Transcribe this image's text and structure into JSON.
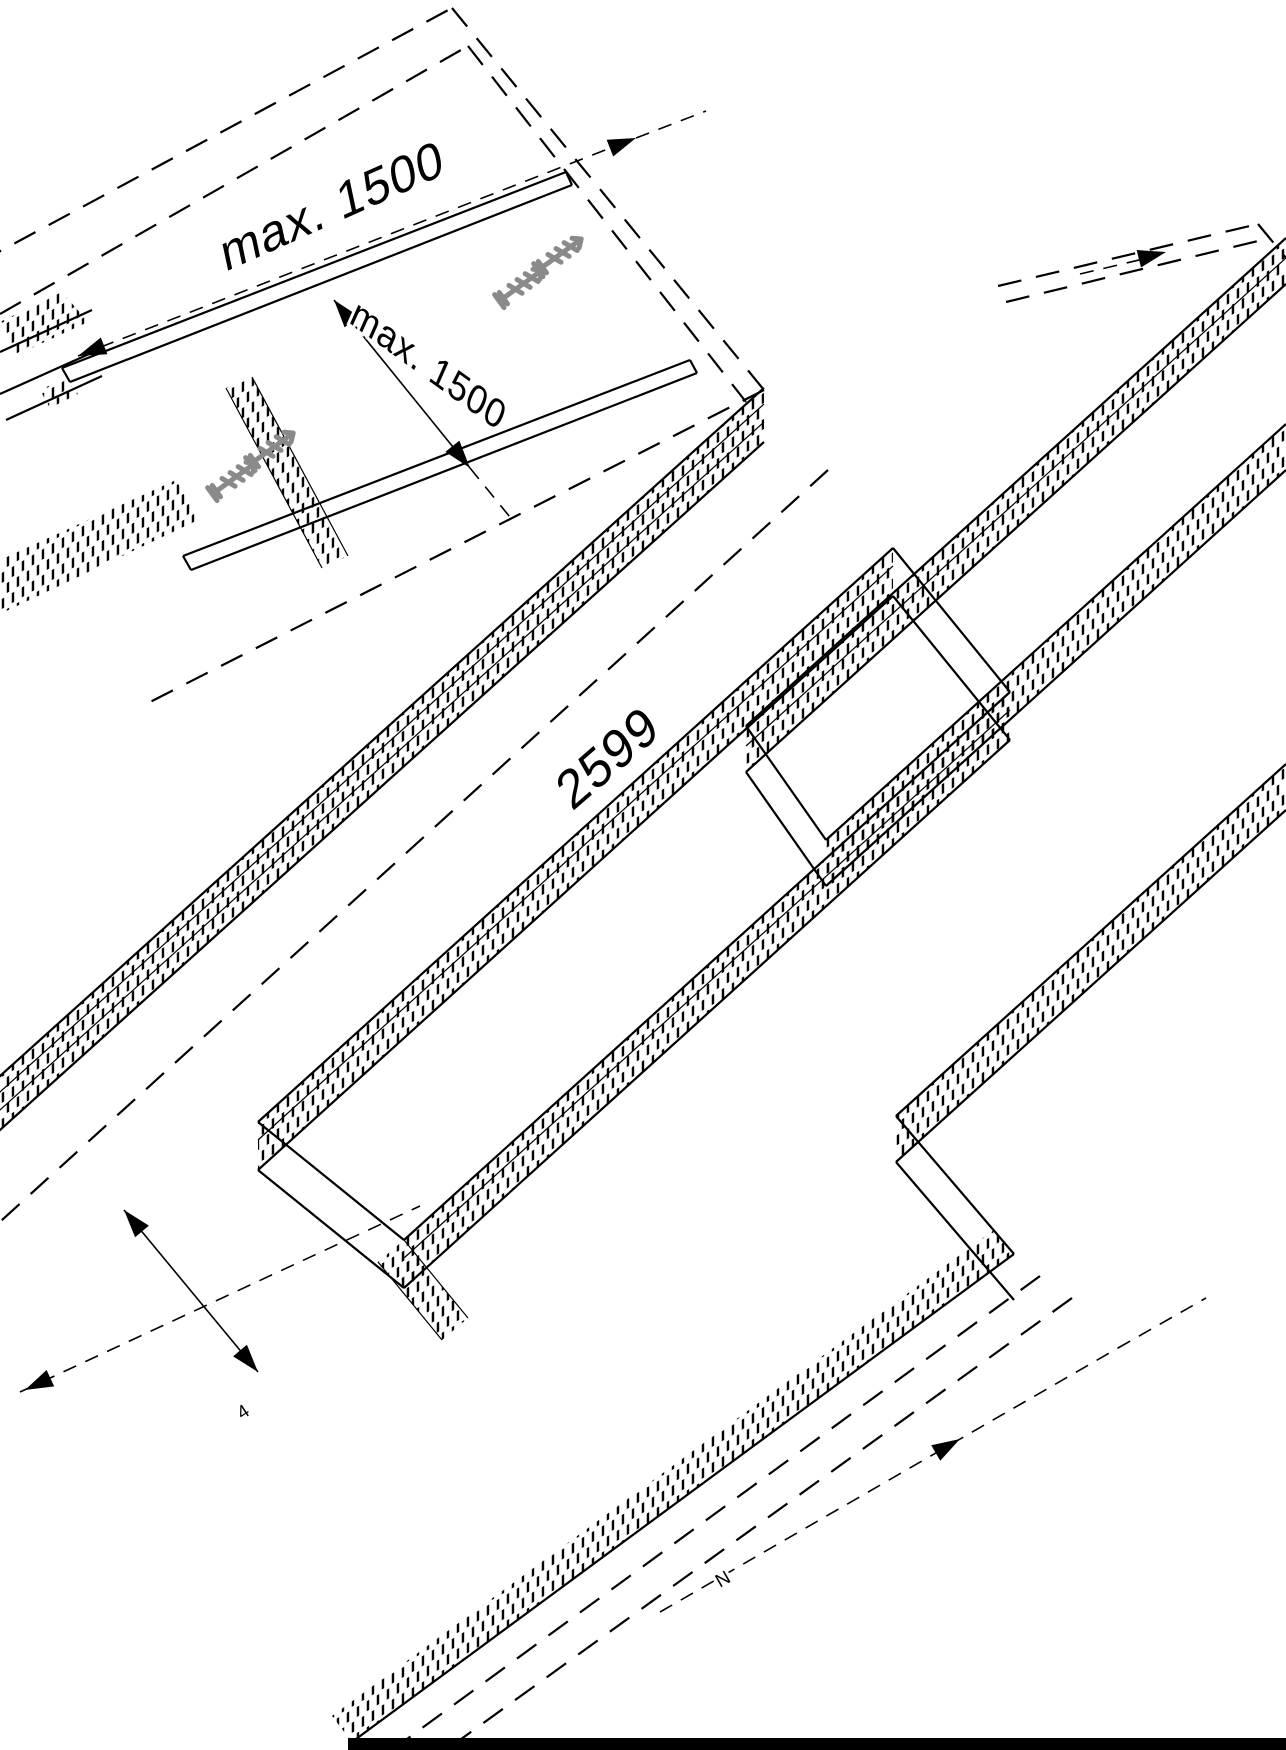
{
  "figure": {
    "type": "isometric-assembly-drawing",
    "description": "Mounting of sandwich panels onto battens fixed on a roof deck",
    "labels": {
      "dim_batten_spacing_top": "max. 1500",
      "dim_batten_spacing_mid": "max. 1500",
      "dim_panel_length": "2599",
      "dim_edge_small": "4",
      "dim_bottom_small": "N"
    },
    "colors": {
      "ink": "#000000",
      "screw": "#8a8a8a",
      "background": "#ffffff"
    }
  }
}
